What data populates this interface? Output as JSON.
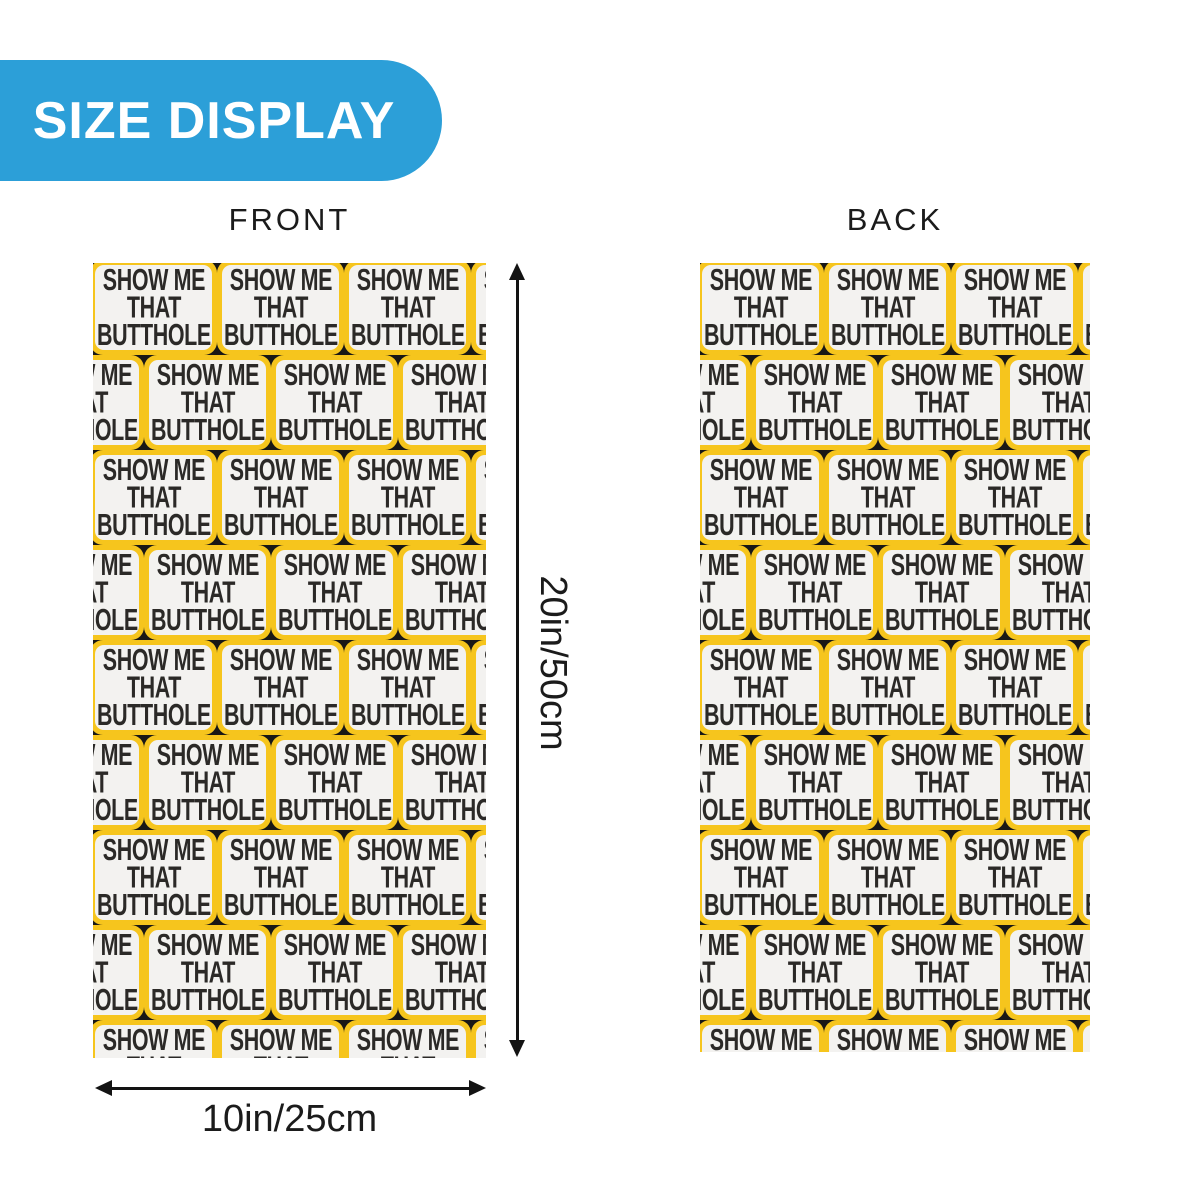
{
  "banner": {
    "label": "SIZE DISPLAY"
  },
  "front": {
    "label": "FRONT"
  },
  "back": {
    "label": "BACK"
  },
  "tile": {
    "lines": [
      "SHOW ME",
      "THAT",
      "BUTTHOLE"
    ]
  },
  "dimensions": {
    "height_label": "20in/50cm",
    "width_label": "10in/25cm"
  },
  "pattern": {
    "rows": 9,
    "cols": 4,
    "tile_width": 127,
    "tile_height": 95,
    "row_offset_even": -3,
    "row_offset_odd": -76,
    "top_offset": -3
  },
  "colors": {
    "banner_bg": "#2C9FD8",
    "banner_text": "#FFFFFF",
    "tile_border": "#F6C51D",
    "tile_bg": "#F3F2F0",
    "tile_text": "#2B2927",
    "tile_gap": "#191816",
    "label_text": "#1B1B1B",
    "arrow": "#131313",
    "page_bg": "#FFFFFF"
  }
}
